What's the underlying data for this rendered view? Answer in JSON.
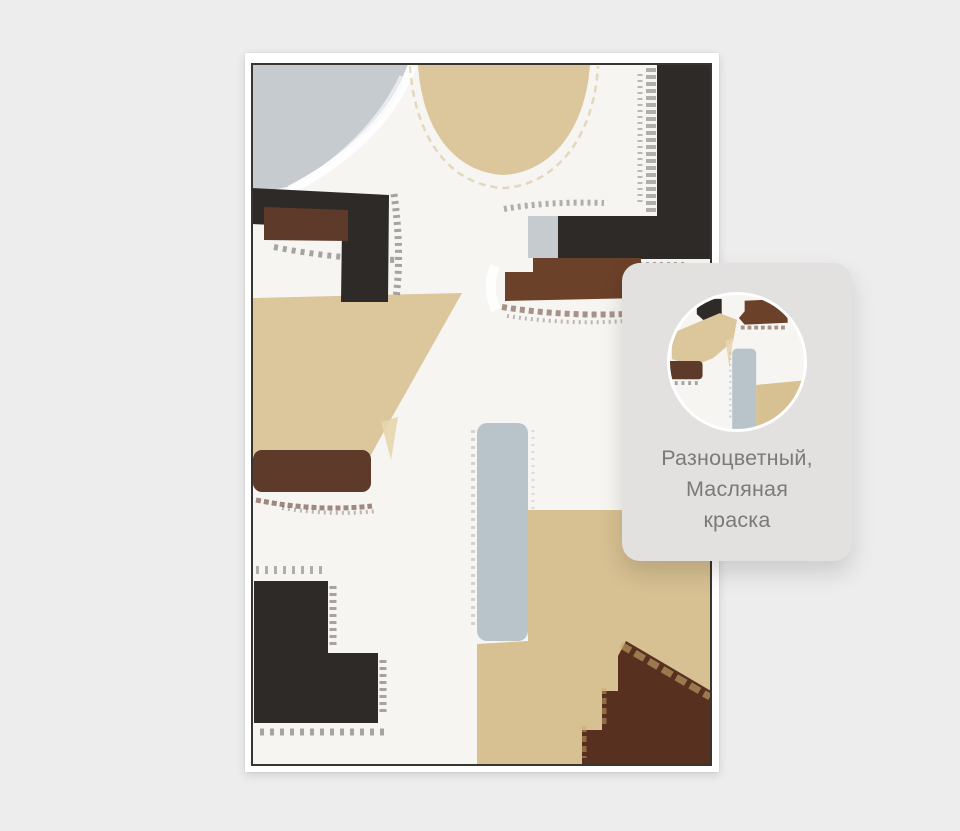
{
  "page": {
    "background": "#ededee"
  },
  "artwork": {
    "description": "abstract-oil-painting-in-white-frame",
    "palette": {
      "page_bg": "#ededee",
      "frame": "#ffffff",
      "canvas": "#f6f5f2",
      "canvas_edge": "#38342f",
      "black": "#2d2a28",
      "brown": "#5d3a29",
      "brown_mid": "#6b4129",
      "brown_dark": "#57301f",
      "beige": "#dcc69b",
      "beige_dark": "#d7c092",
      "bluegray": "#c5cbce",
      "bluegray_bar": "#b9c4ca",
      "gold": "#c9a96e",
      "card_bg": "#e2e1df",
      "card_text": "#7a7a7a"
    }
  },
  "detail_card": {
    "lines": [
      "Разноцветный,",
      "Масляная",
      "краска"
    ]
  }
}
